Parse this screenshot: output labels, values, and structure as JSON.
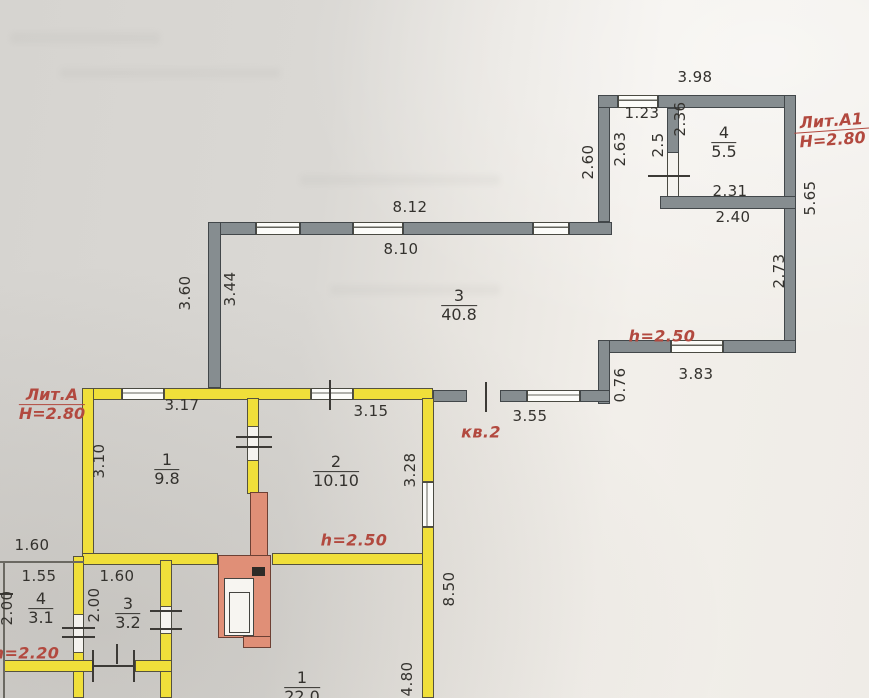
{
  "document": "BTI technical floor plan scan",
  "annotations": {
    "lit_a1_name": "Лит.А1",
    "lit_a1_height": "Н=2.80",
    "lit_a_name": "Лит.А",
    "lit_a_height": "Н=2.80",
    "apartment": "кв.2",
    "h_room3": "h=2.50",
    "h_room2": "h=2.50",
    "h_porch": "h=2.20"
  },
  "rooms": {
    "r3": {
      "number": "3",
      "area": "40.8"
    },
    "r4_annex": {
      "number": "4",
      "area": "5.5"
    },
    "r1": {
      "number": "1",
      "area": "9.8"
    },
    "r2": {
      "number": "2",
      "area": "10.10"
    },
    "r4_porch": {
      "number": "4",
      "area": "3.1"
    },
    "r3_porch": {
      "number": "3",
      "area": "3.2"
    },
    "r1_lower": {
      "number": "1",
      "area": "22.0"
    }
  },
  "dims": {
    "d398": "3.98",
    "d123": "1.23",
    "d236": "2.36",
    "d25": "2.5",
    "d263": "2.63",
    "d260": "2.60",
    "d231": "2.31",
    "d240": "2.40",
    "d565": "5.65",
    "d273": "2.73",
    "d812": "8.12",
    "d810": "8.10",
    "d360": "3.60",
    "d344": "3.44",
    "d383": "3.83",
    "d076": "0.76",
    "d355": "3.55",
    "d317": "3.17",
    "d315": "3.15",
    "d310": "3.10",
    "d328": "3.28",
    "d160a": "1.60",
    "d155": "1.55",
    "d160b": "1.60",
    "d200a": "2.00",
    "d200b": "2.00",
    "d850": "8.50",
    "d480": "4.80"
  },
  "colors": {
    "wall_lit_a": "#f0df3a",
    "wall_lit_a1": "#868d90",
    "stove": "#e08f77",
    "annotation_red": "#b2493f",
    "dimension_text": "#34322e"
  }
}
